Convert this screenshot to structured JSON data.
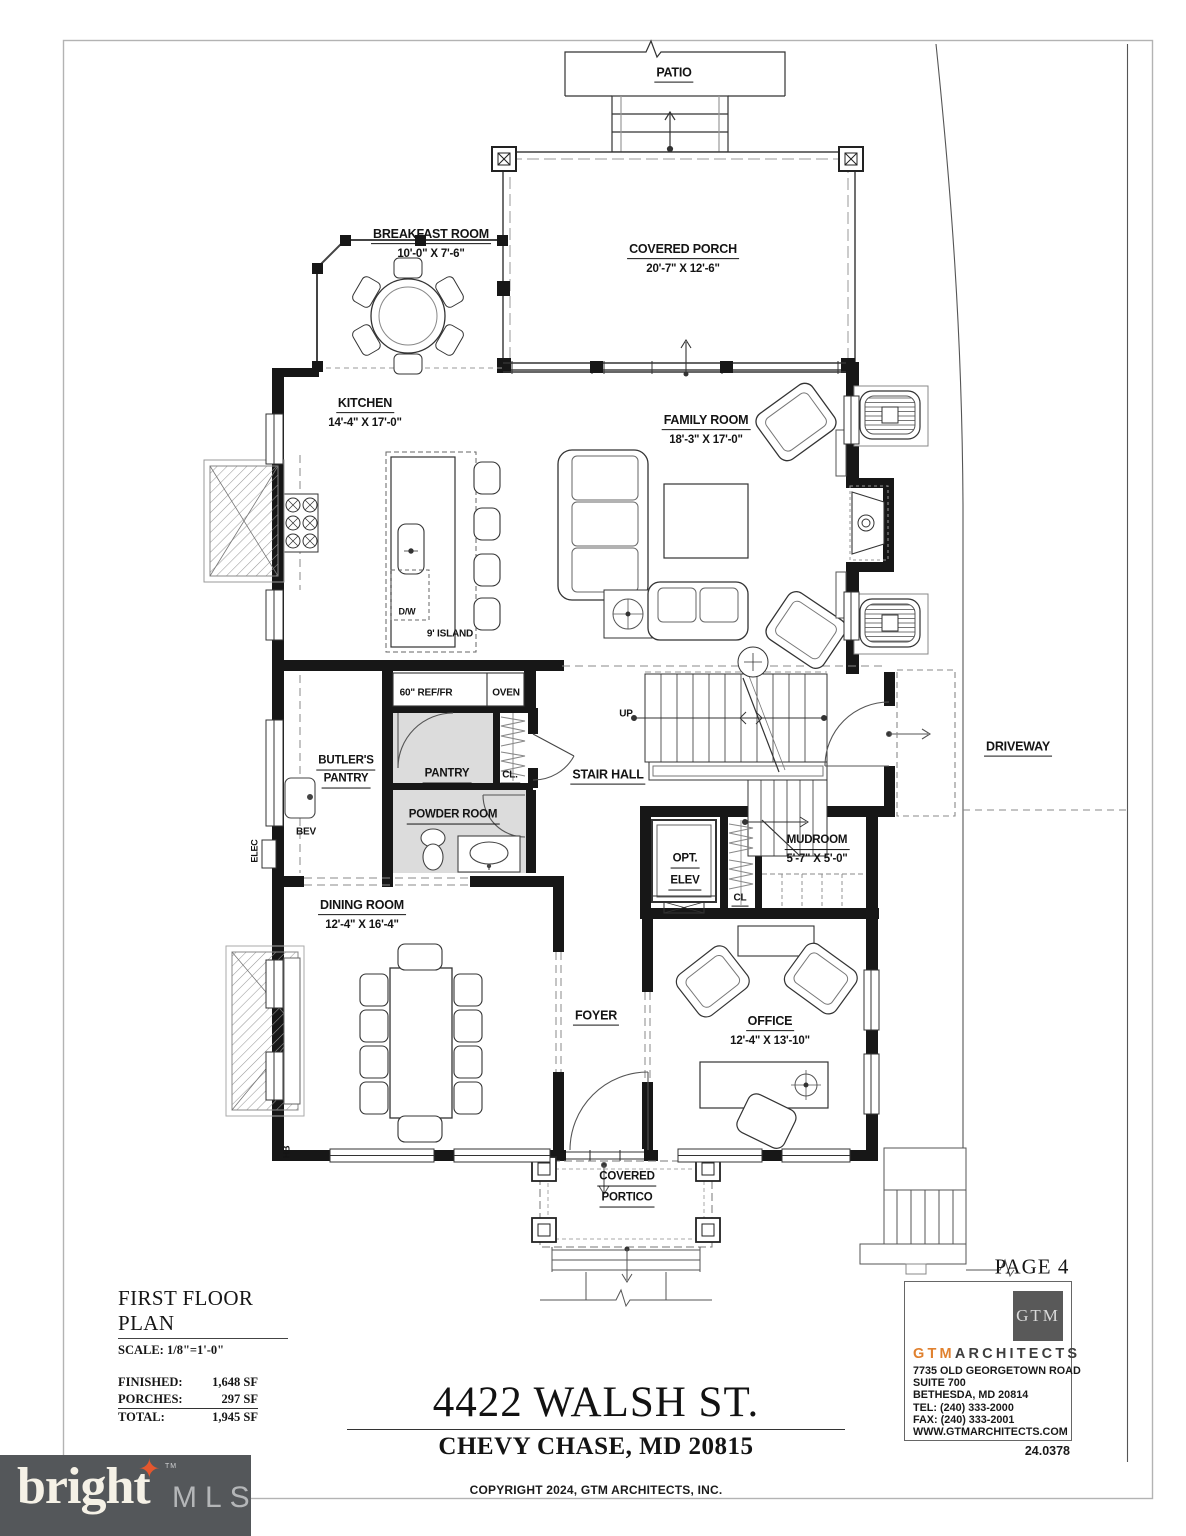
{
  "patio": {
    "name": "PATIO"
  },
  "rooms": {
    "breakfast": {
      "name": "BREAKFAST ROOM",
      "dims": "10'-0\" X 7'-6\""
    },
    "porch": {
      "name": "COVERED PORCH",
      "dims": "20'-7\" X 12'-6\""
    },
    "kitchen": {
      "name": "KITCHEN",
      "dims": "14'-4\" X 17'-0\""
    },
    "family": {
      "name": "FAMILY ROOM",
      "dims": "18'-3\" X 17'-0\""
    },
    "butlers": {
      "line1": "BUTLER'S",
      "line2": "PANTRY"
    },
    "pantry": {
      "name": "PANTRY"
    },
    "powder": {
      "name": "POWDER ROOM"
    },
    "stair_hall": {
      "name": "STAIR HALL"
    },
    "opt_elev": {
      "line1": "OPT.",
      "line2": "ELEV"
    },
    "mudroom": {
      "name": "MUDROOM",
      "dims": "5'-7\" X 5'-0\""
    },
    "dining": {
      "name": "DINING ROOM",
      "dims": "12'-4\" X 16'-4\""
    },
    "foyer": {
      "name": "FOYER"
    },
    "office": {
      "name": "OFFICE",
      "dims": "12'-4\" X 13'-10\""
    },
    "portico": {
      "line1": "COVERED",
      "line2": "PORTICO"
    }
  },
  "annotations": {
    "up": "UP",
    "ref": "60\" REF/FR",
    "oven": "OVEN",
    "cl_pantry": "CL.",
    "cl_mudroom": "CL",
    "dw": "D/W",
    "island": "9' ISLAND",
    "bev": "BEV",
    "elec": "ELEC",
    "hb": "HB",
    "driveway": "DRIVEWAY",
    "page": "PAGE 4"
  },
  "title_block": {
    "title": "FIRST FLOOR PLAN",
    "scale": "SCALE: 1/8\"=1'-0\"",
    "areas": [
      {
        "label": "FINISHED:",
        "value": "1,648 SF"
      },
      {
        "label": "PORCHES:",
        "value": "297 SF"
      },
      {
        "label": "TOTAL:",
        "value": "1,945 SF"
      }
    ]
  },
  "address": {
    "street": "4422 WALSH ST.",
    "city": "CHEVY CHASE, MD 20815",
    "copyright": "COPYRIGHT 2024, GTM ARCHITECTS, INC."
  },
  "firm": {
    "logo": "GTM",
    "brand_accent": "GTM",
    "brand_rest": "ARCHITECTS",
    "address1": "7735 OLD GEORGETOWN ROAD",
    "address2": "SUITE 700",
    "address3": "BETHESDA, MD 20814",
    "tel": "TEL: (240) 333-2000",
    "fax": "FAX: (240) 333-2001",
    "web": "WWW.GTMARCHITECTS.COM",
    "project_number": "24.0378"
  },
  "watermark": {
    "brand": "bright",
    "tm": "TM",
    "sub": "MLS"
  },
  "colors": {
    "ink": "#141414",
    "room_fill": "#dcdcdc",
    "accent_orange": "#e0812f",
    "logo_gray": "#595959",
    "watermark_bg": "#54575a",
    "watermark_text": "#f5f1e6",
    "watermark_sub": "#b4b6b8",
    "star_orange": "#e4572e"
  }
}
